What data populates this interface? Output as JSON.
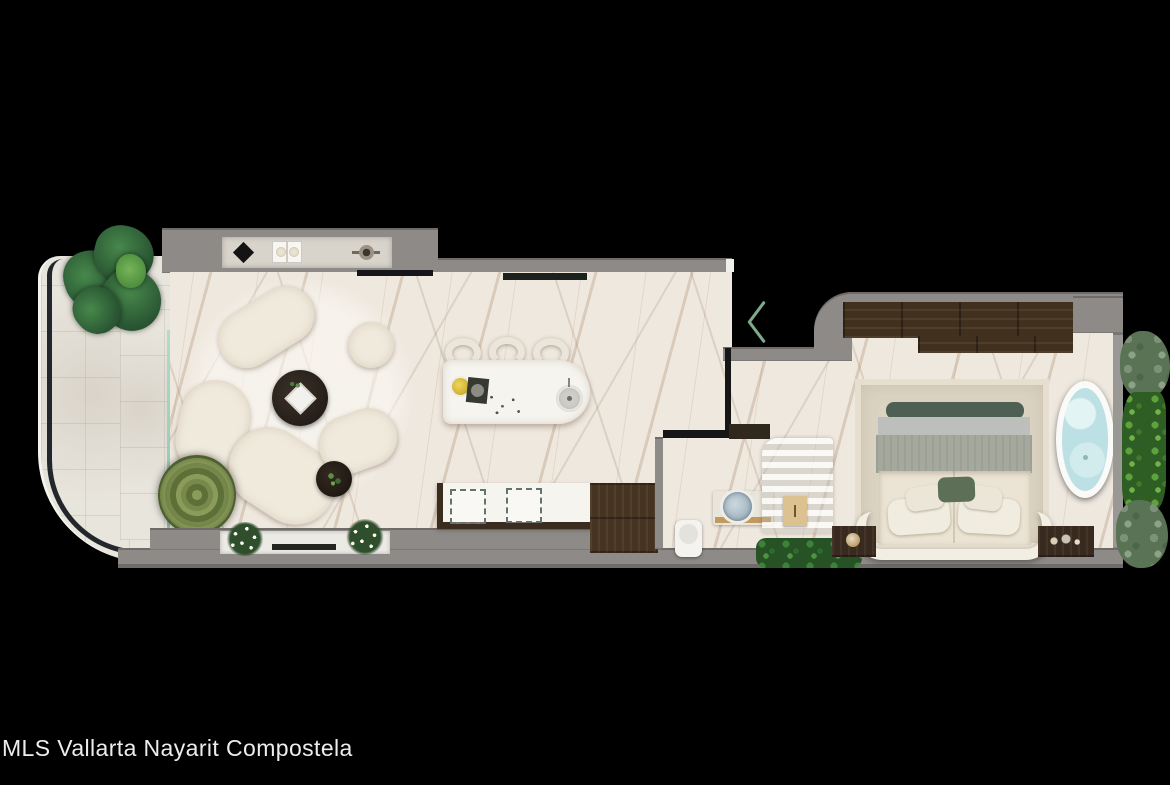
{
  "caption": {
    "text": "MLS Vallarta Nayarit Compostela",
    "color": "#ededed"
  },
  "nav": {
    "back_chevron": {
      "glyph": "<",
      "direction": "left",
      "color": "#7fa98a"
    }
  },
  "palette": {
    "background": "#000000",
    "wall_gray": "#8d8a87",
    "marble_floor": "#efe8df",
    "terrace_tile": "#e8e5dd",
    "dark_wood": "#42301f",
    "sofa_cream": "#f0eadd",
    "tub_water": "#bdelete",
    "bathtub_water": "#bce0e4",
    "glass_teal": "#8fd3bd",
    "plant_green": "#3f7d42"
  },
  "scene": {
    "type": "apartment floor plan, top-down 3D render",
    "rooms": [
      {
        "name": "terrace",
        "objects": [
          "curved railing",
          "monstera plant",
          "succulent plant",
          "glass sliding door"
        ]
      },
      {
        "name": "living room",
        "objects": [
          "round rug",
          "curved modular sofa",
          "round coffee table",
          "pouf",
          "side table",
          "wall console",
          "tv",
          "window sill flowers"
        ]
      },
      {
        "name": "kitchen",
        "objects": [
          "island with sink",
          "three stools",
          "counter with appliances",
          "wood closet floor"
        ]
      },
      {
        "name": "bathroom",
        "objects": [
          "toilet",
          "vanity basin"
        ]
      },
      {
        "name": "hall",
        "objects": [
          "louvered stair screen",
          "mat",
          "planter moss"
        ]
      },
      {
        "name": "bedroom",
        "objects": [
          "wardrobe",
          "area rug",
          "bed with pillows",
          "headboard",
          "nightstands",
          "freestanding bathtub",
          "vertical garden"
        ]
      }
    ]
  }
}
